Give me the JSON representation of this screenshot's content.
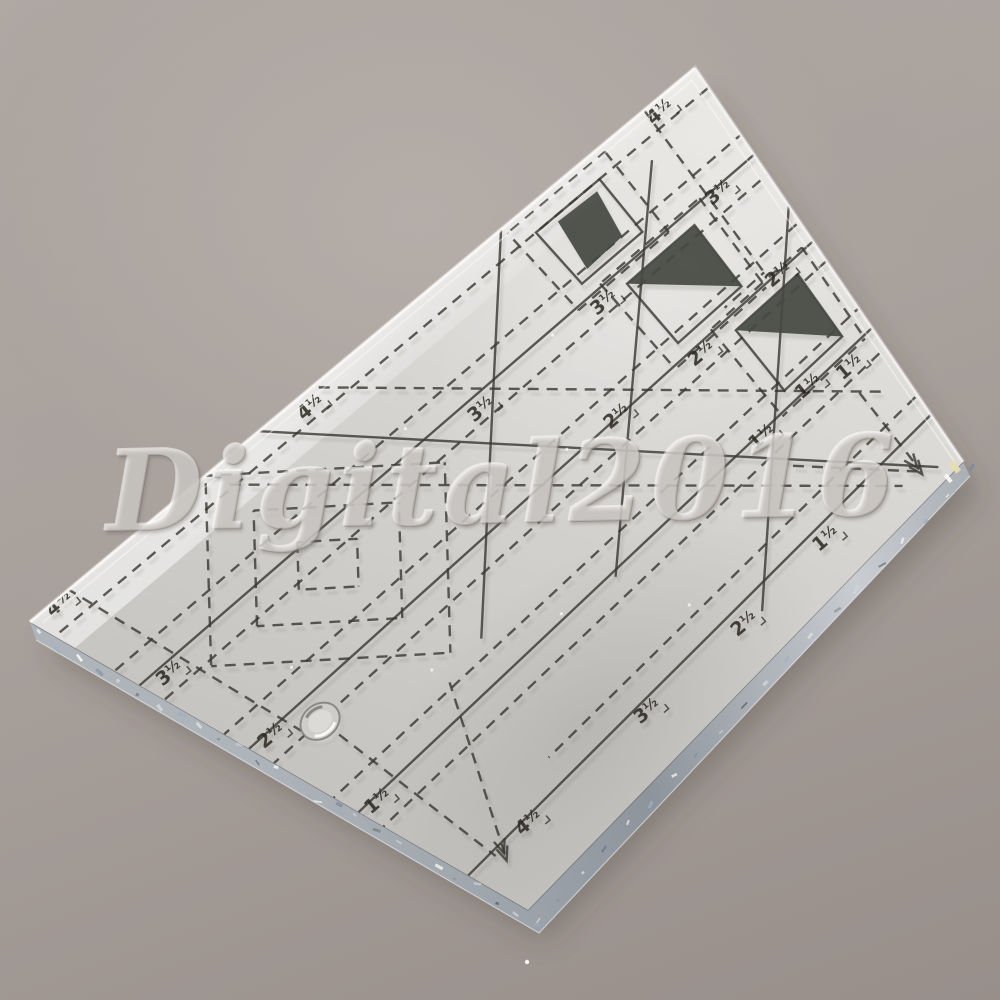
{
  "scene": {
    "description": "Clear acrylic quilting template ruler lying rotated on a gray surface",
    "background_color": "#a8a09b",
    "watermark": {
      "text": "Digital2016"
    },
    "ruler": {
      "face_color": "#d6d4d1",
      "marking_color": "#3a3934",
      "patch_color": "#454a42",
      "bevel_color": "#9aa2ab",
      "units_note": "measurement labels printed on template",
      "labels": [
        {
          "text": "4½",
          "u": 0.18,
          "v": 0.45
        },
        {
          "text": "3½",
          "u": 1.22,
          "v": 0.45
        },
        {
          "text": "2½",
          "u": 2.28,
          "v": 0.45
        },
        {
          "text": "1½",
          "u": 3.5,
          "v": 0.42
        },
        {
          "text": "4½",
          "u": 0.2,
          "v": 4.3
        },
        {
          "text": "3½",
          "u": 1.3,
          "v": 3.33
        },
        {
          "text": "2½",
          "u": 2.25,
          "v": 2.5
        },
        {
          "text": "1½",
          "u": 3.4,
          "v": 1.58
        },
        {
          "text": "3½",
          "u": 1.3,
          "v": 1.87
        },
        {
          "text": "2½",
          "u": 2.35,
          "v": 1.5
        },
        {
          "text": "1½",
          "u": 3.35,
          "v": 0.88
        },
        {
          "text": "4½",
          "u": 0.1,
          "v": 6.95
        },
        {
          "text": "3½",
          "u": 1.25,
          "v": 6.98
        },
        {
          "text": "2½",
          "u": 2.3,
          "v": 7.0
        },
        {
          "text": "1½",
          "u": 3.4,
          "v": 7.02
        },
        {
          "text": "3½",
          "u": 4.55,
          "v": 4.55
        },
        {
          "text": "2½",
          "u": 4.62,
          "v": 3.1
        },
        {
          "text": "1½",
          "u": 4.6,
          "v": 1.78
        },
        {
          "text": "4½",
          "u": 4.5,
          "v": 6.35
        }
      ],
      "solid_lines": [
        [
          1.1,
          0,
          1.1,
          7.2
        ],
        [
          2.2,
          0,
          2.2,
          7.2
        ],
        [
          3.3,
          0,
          3.3,
          7.2
        ],
        [
          4.4,
          0,
          4.4,
          7.2
        ],
        [
          0,
          4.72,
          4.85,
          0.27
        ],
        [
          0,
          2.1,
          2.9,
          5.0
        ],
        [
          0.45,
          0.75,
          3.35,
          3.65
        ],
        [
          1.75,
          0,
          4.6,
          2.85
        ]
      ],
      "dashed_lines": [
        [
          0.25,
          0,
          0.25,
          7.2
        ],
        [
          0.85,
          0,
          0.85,
          7.2
        ],
        [
          1.35,
          0,
          1.35,
          7.2
        ],
        [
          1.95,
          0,
          1.95,
          7.2
        ],
        [
          2.45,
          0,
          2.45,
          7.2
        ],
        [
          3.05,
          0,
          3.05,
          7.2
        ],
        [
          3.55,
          0,
          3.55,
          7.2
        ],
        [
          4.15,
          0,
          4.15,
          5.6
        ],
        [
          0,
          0.55,
          2.1,
          0.55
        ],
        [
          2.1,
          0.55,
          2.1,
          1.05
        ],
        [
          0,
          4.15,
          3.9,
          0.25
        ],
        [
          0.2,
          5.25,
          4.72,
          0.73
        ],
        [
          0,
          6.78,
          2.4,
          6.78
        ],
        [
          1.4,
          3.9,
          2.8,
          5.3
        ],
        [
          2.8,
          5.3,
          1.4,
          6.7
        ],
        [
          1.4,
          6.7,
          0,
          5.3
        ],
        [
          0,
          5.3,
          1.4,
          3.9
        ],
        [
          1.4,
          4.45,
          2.25,
          5.3
        ],
        [
          2.25,
          5.3,
          1.4,
          6.15
        ],
        [
          1.4,
          6.15,
          0.55,
          5.3
        ],
        [
          0.55,
          5.3,
          1.4,
          4.45
        ],
        [
          1.4,
          4.95,
          1.75,
          5.3
        ],
        [
          1.75,
          5.3,
          1.4,
          5.65
        ],
        [
          1.4,
          5.65,
          1.05,
          5.3
        ],
        [
          1.05,
          5.3,
          1.4,
          4.95
        ],
        [
          3.62,
          0.5,
          4.72,
          0.46
        ],
        [
          3.75,
          1.55,
          4.72,
          0.5
        ],
        [
          3.0,
          5.55,
          4.5,
          6.78
        ],
        [
          2.55,
          6.6,
          4.45,
          6.85
        ]
      ],
      "outline_squares": [
        [
          0.25,
          1.2,
          0.95,
          1.9
        ],
        [
          1.25,
          0.8,
          2.05,
          1.6
        ],
        [
          2.35,
          0.3,
          3.15,
          1.1
        ]
      ],
      "dark_triangles": [
        [
          1.25,
          0.8,
          2.05,
          0.8,
          1.25,
          1.6
        ],
        [
          2.35,
          0.3,
          3.15,
          0.3,
          2.35,
          1.1
        ]
      ],
      "dark_parallelogram": [
        [
          0.31,
          1.7
        ],
        [
          0.33,
          1.28
        ],
        [
          0.85,
          1.36
        ],
        [
          0.87,
          1.78
        ]
      ],
      "arrows": [
        {
          "tip": [
            4.78,
            0.47
          ],
          "back": [
            3.9,
            0.5
          ]
        },
        {
          "tip": [
            4.55,
            6.83
          ],
          "back": [
            3.4,
            5.9
          ]
        }
      ],
      "hole": {
        "u": 2.45,
        "v": 6.6
      }
    }
  }
}
